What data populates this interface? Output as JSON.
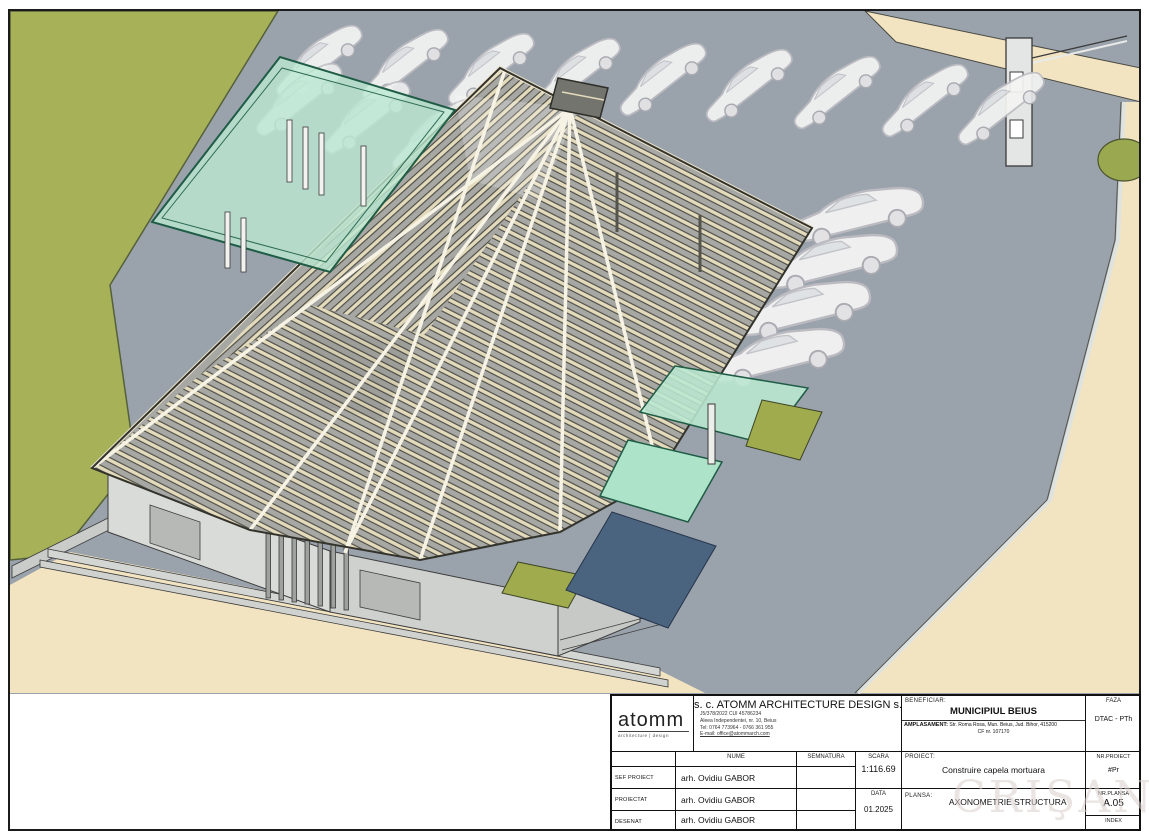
{
  "sheet": {
    "type": "architectural axonometric drawing",
    "colors": {
      "lawn": "#a7b258",
      "road": "#9aa2ab",
      "sidewalk_beige": "#f2e4c1",
      "glass_canopy": "#b9e7d0",
      "water_blue": "#4a6480",
      "roof_timber": "#e4dbbc",
      "building_wall": "#d9dbd8",
      "olive_patch": "#9fab4d"
    }
  },
  "titleblock": {
    "logo": {
      "name": "atomm",
      "tagline": "architecture | design"
    },
    "company": {
      "name": "s. c. ATOMM ARCHITECTURE DESIGN s. r. l.",
      "reg_line": "J5/378/2022    CUI 45786234",
      "address_line": "Aleea Independentei, nr. 10, Beius",
      "phone_line": "Tel: 0764 773964 - 0766 361 955",
      "email_line": "E-mail: office@atommarch.com"
    },
    "beneficiar": {
      "label": "BENEFICIAR:",
      "value": "MUNICIPIUL BEIUS"
    },
    "amplasament": {
      "label": "AMPLASAMENT:",
      "value": "Str. Roma Rosa, Mun. Beius, Jud. Bihor, 415200",
      "value2": "CF nr. 107170"
    },
    "faza": {
      "label": "FAZA",
      "value": "DTAC - PTh"
    },
    "table": {
      "headers": {
        "nume": "NUME",
        "semnatura": "SEMNATURA",
        "scara": "SCARA"
      },
      "rows": [
        {
          "role": "SEF PROIECT",
          "name": "arh. Ovidiu GABOR"
        },
        {
          "role": "PROIECTAT",
          "name": "arh. Ovidiu GABOR"
        },
        {
          "role": "DESENAT",
          "name": "arh. Ovidiu GABOR"
        }
      ],
      "scara_value": "1:116.69",
      "data_label": "DATA",
      "data_value": "01.2025"
    },
    "proiect": {
      "label": "PROIECT:",
      "value": "Construire capela mortuara"
    },
    "plansa": {
      "label": "PLANSA:",
      "value": "AXONOMETRIE STRUCTURA"
    },
    "nr_proiect": {
      "label": "NR.PROIECT",
      "value": "#Pr"
    },
    "nr_plansa": {
      "label": "NR.PLANSA",
      "value": "A.05"
    },
    "index": {
      "label": "INDEX",
      "value": ""
    },
    "watermark": "CRIŞANA"
  }
}
